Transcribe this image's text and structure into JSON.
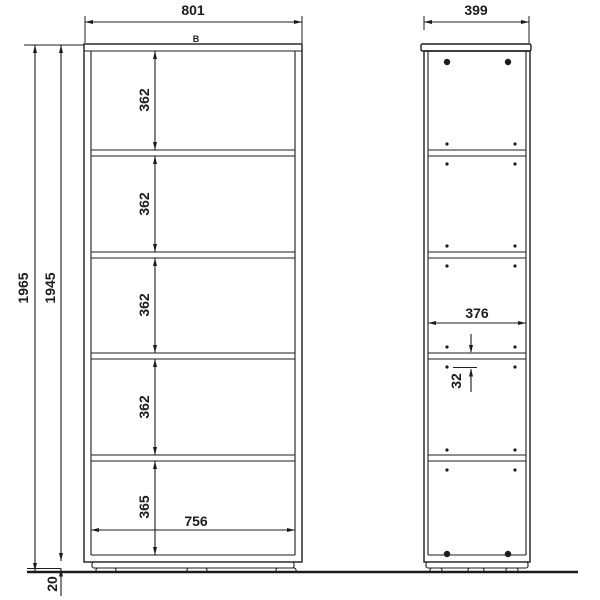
{
  "drawing": {
    "front_view": {
      "top_width": "801",
      "marker_label": "B",
      "overall_height": "1965",
      "body_height": "1945",
      "base_height": "20",
      "section_heights": [
        "362",
        "362",
        "362",
        "362",
        "365"
      ],
      "inner_width": "756"
    },
    "side_view": {
      "top_depth": "399",
      "inner_depth": "376",
      "hole_spacing": "32"
    },
    "colors": {
      "line": "#1c1c1c",
      "background": "#ffffff"
    }
  }
}
